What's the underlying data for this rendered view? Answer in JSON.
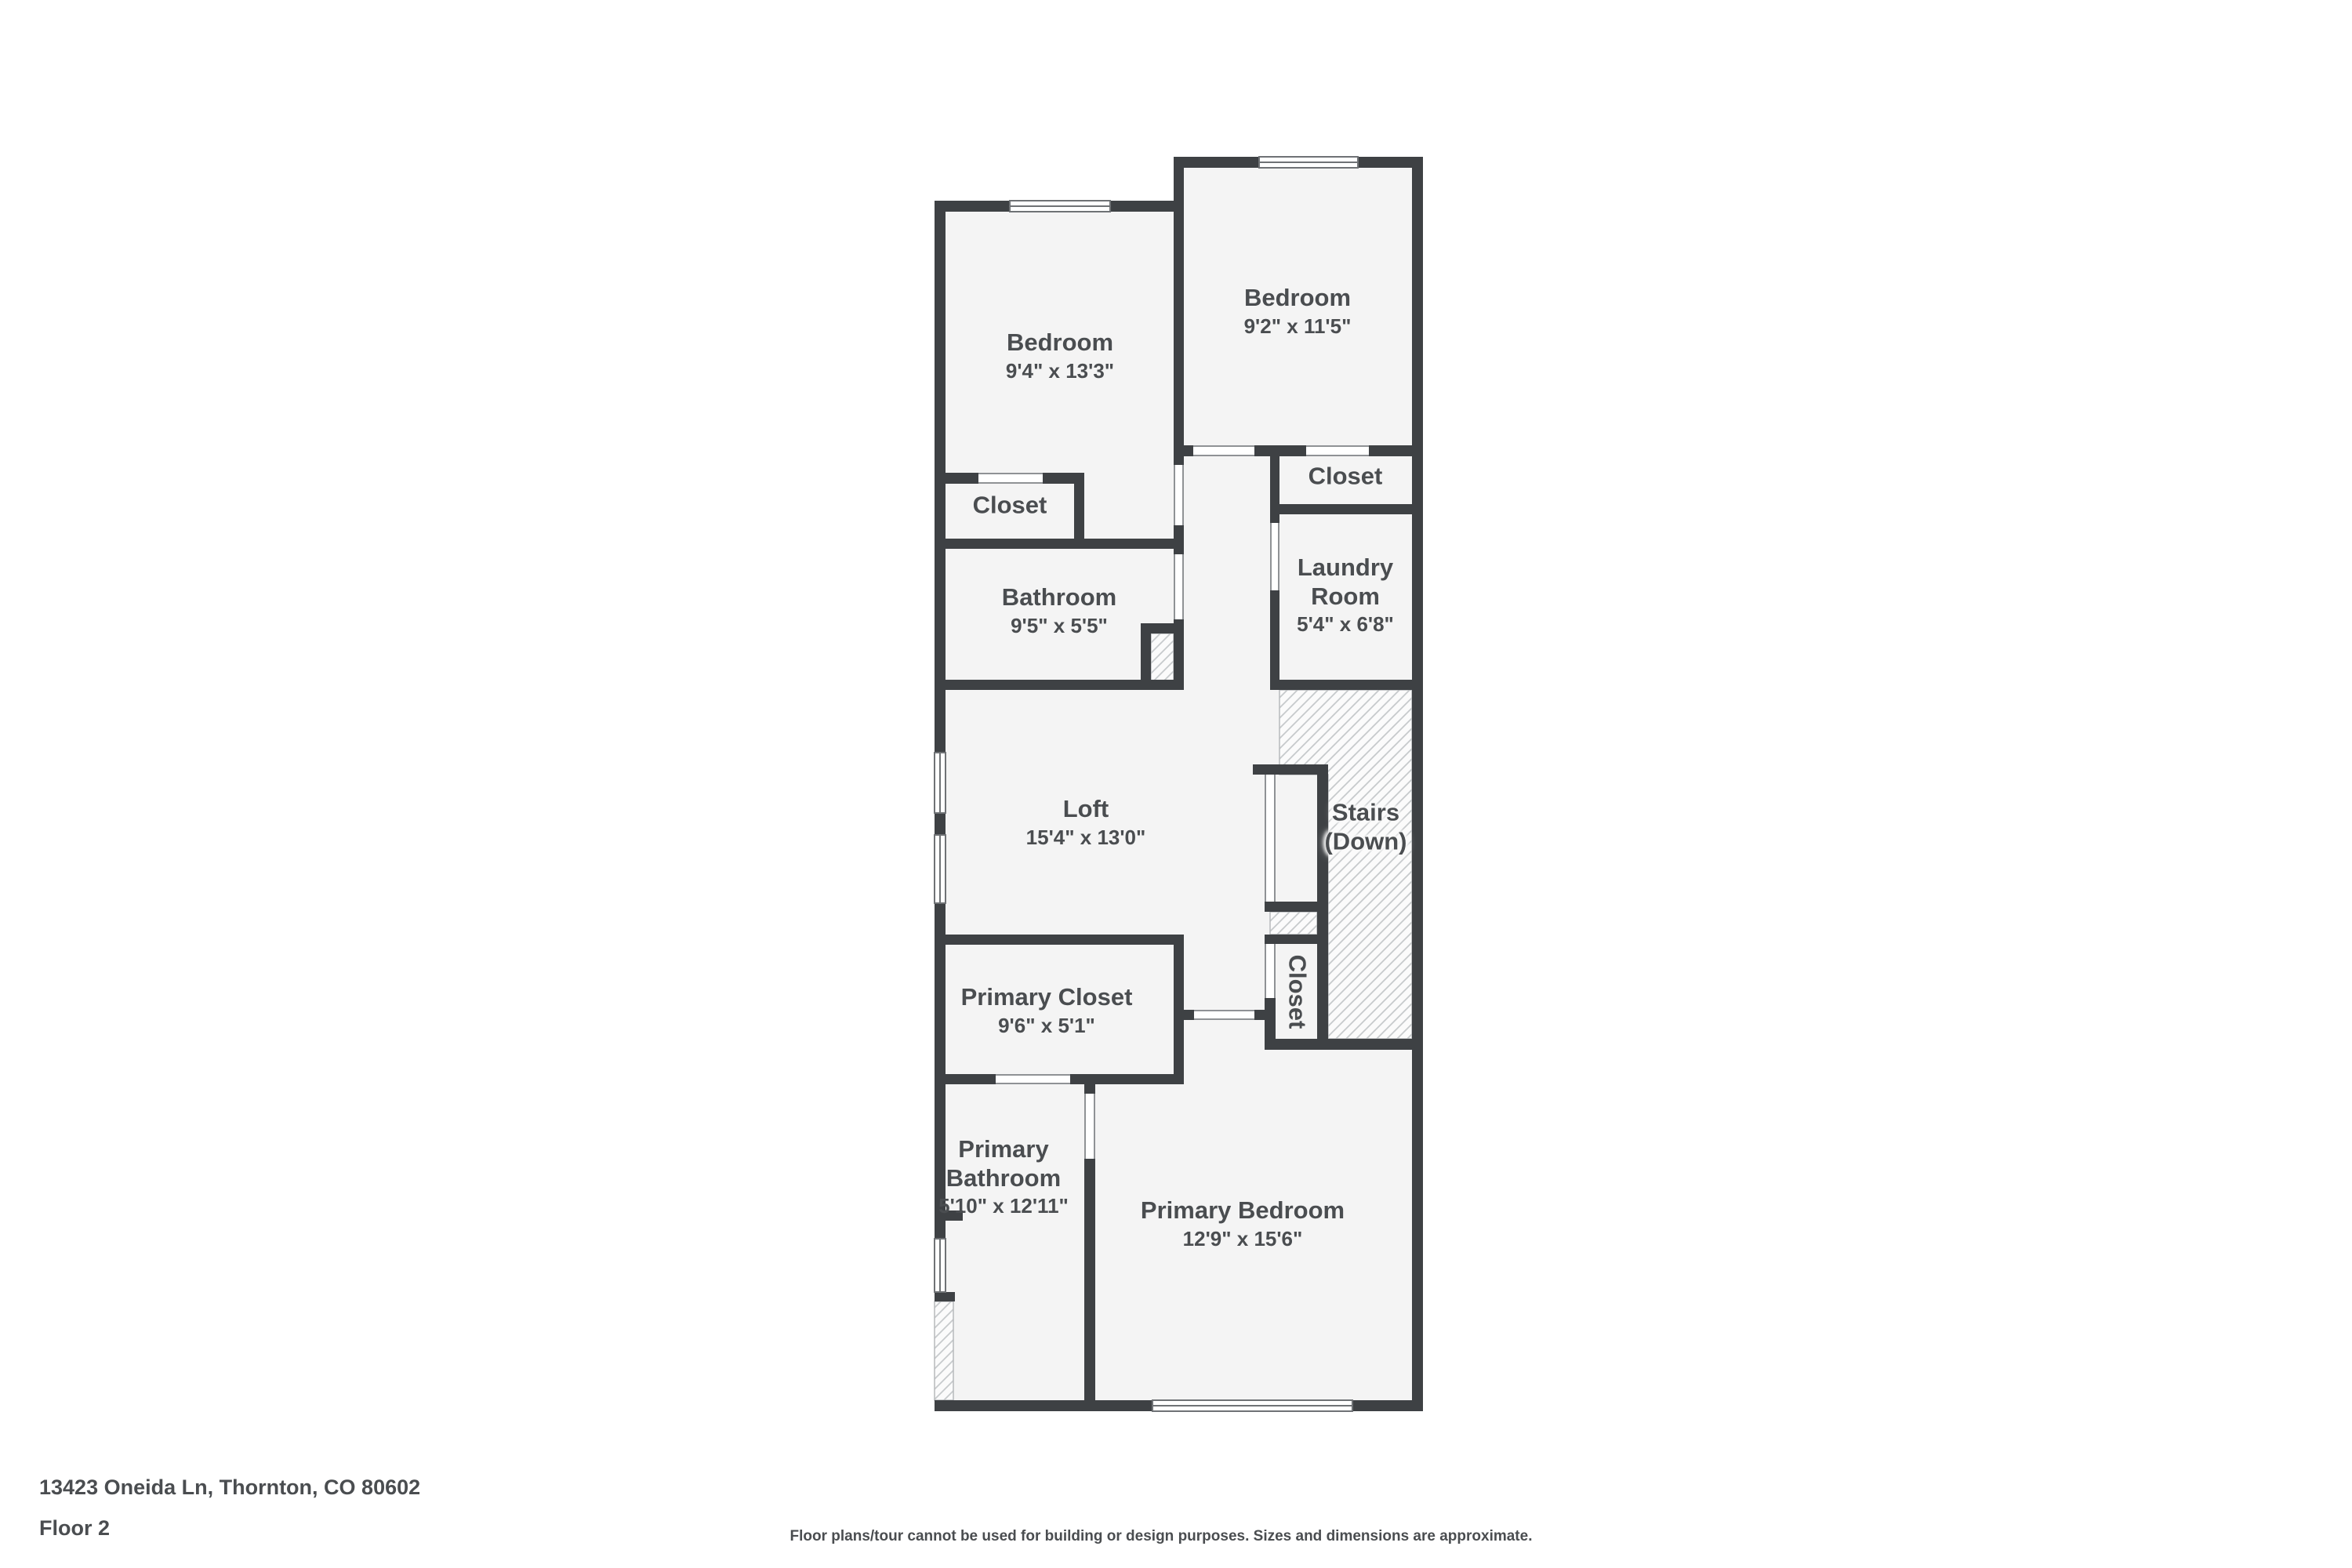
{
  "title": "Floor plan - Floor 2",
  "colors": {
    "wall": "#3e4144",
    "room_fill": "#f4f4f4",
    "label": "#4a4d50",
    "hatch_line": "#c7cacc",
    "hatch_fill": "#fbfbfb",
    "opening_line": "#8f9295",
    "window_line": "#6f7275",
    "background": "#ffffff"
  },
  "rooms": {
    "bedroom_left": {
      "name": "Bedroom",
      "dims": "9'4\" x 13'3\""
    },
    "bedroom_right": {
      "name": "Bedroom",
      "dims": "9'2\" x 11'5\""
    },
    "closet_left": {
      "name": "Closet"
    },
    "closet_right": {
      "name": "Closet"
    },
    "bathroom": {
      "name": "Bathroom",
      "dims": "9'5\" x 5'5\""
    },
    "laundry": {
      "name": "Laundry",
      "name2": "Room",
      "dims": "5'4\" x 6'8\""
    },
    "loft": {
      "name": "Loft",
      "dims": "15'4\" x 13'0\""
    },
    "stairs": {
      "name": "Stairs",
      "name2": "(Down)"
    },
    "closet_stairs": {
      "name": "Closet"
    },
    "primary_closet": {
      "name": "Primary Closet",
      "dims": "9'6\" x 5'1\""
    },
    "primary_bathroom": {
      "name": "Primary",
      "name2": "Bathroom",
      "dims": "5'10\" x 12'11\""
    },
    "primary_bedroom": {
      "name": "Primary Bedroom",
      "dims": "12'9\" x 15'6\""
    }
  },
  "footer": {
    "address": "13423 Oneida Ln, Thornton, CO 80602",
    "floor": "Floor 2",
    "disclaimer": "Floor plans/tour cannot be used for building or design purposes. Sizes and dimensions are approximate."
  }
}
